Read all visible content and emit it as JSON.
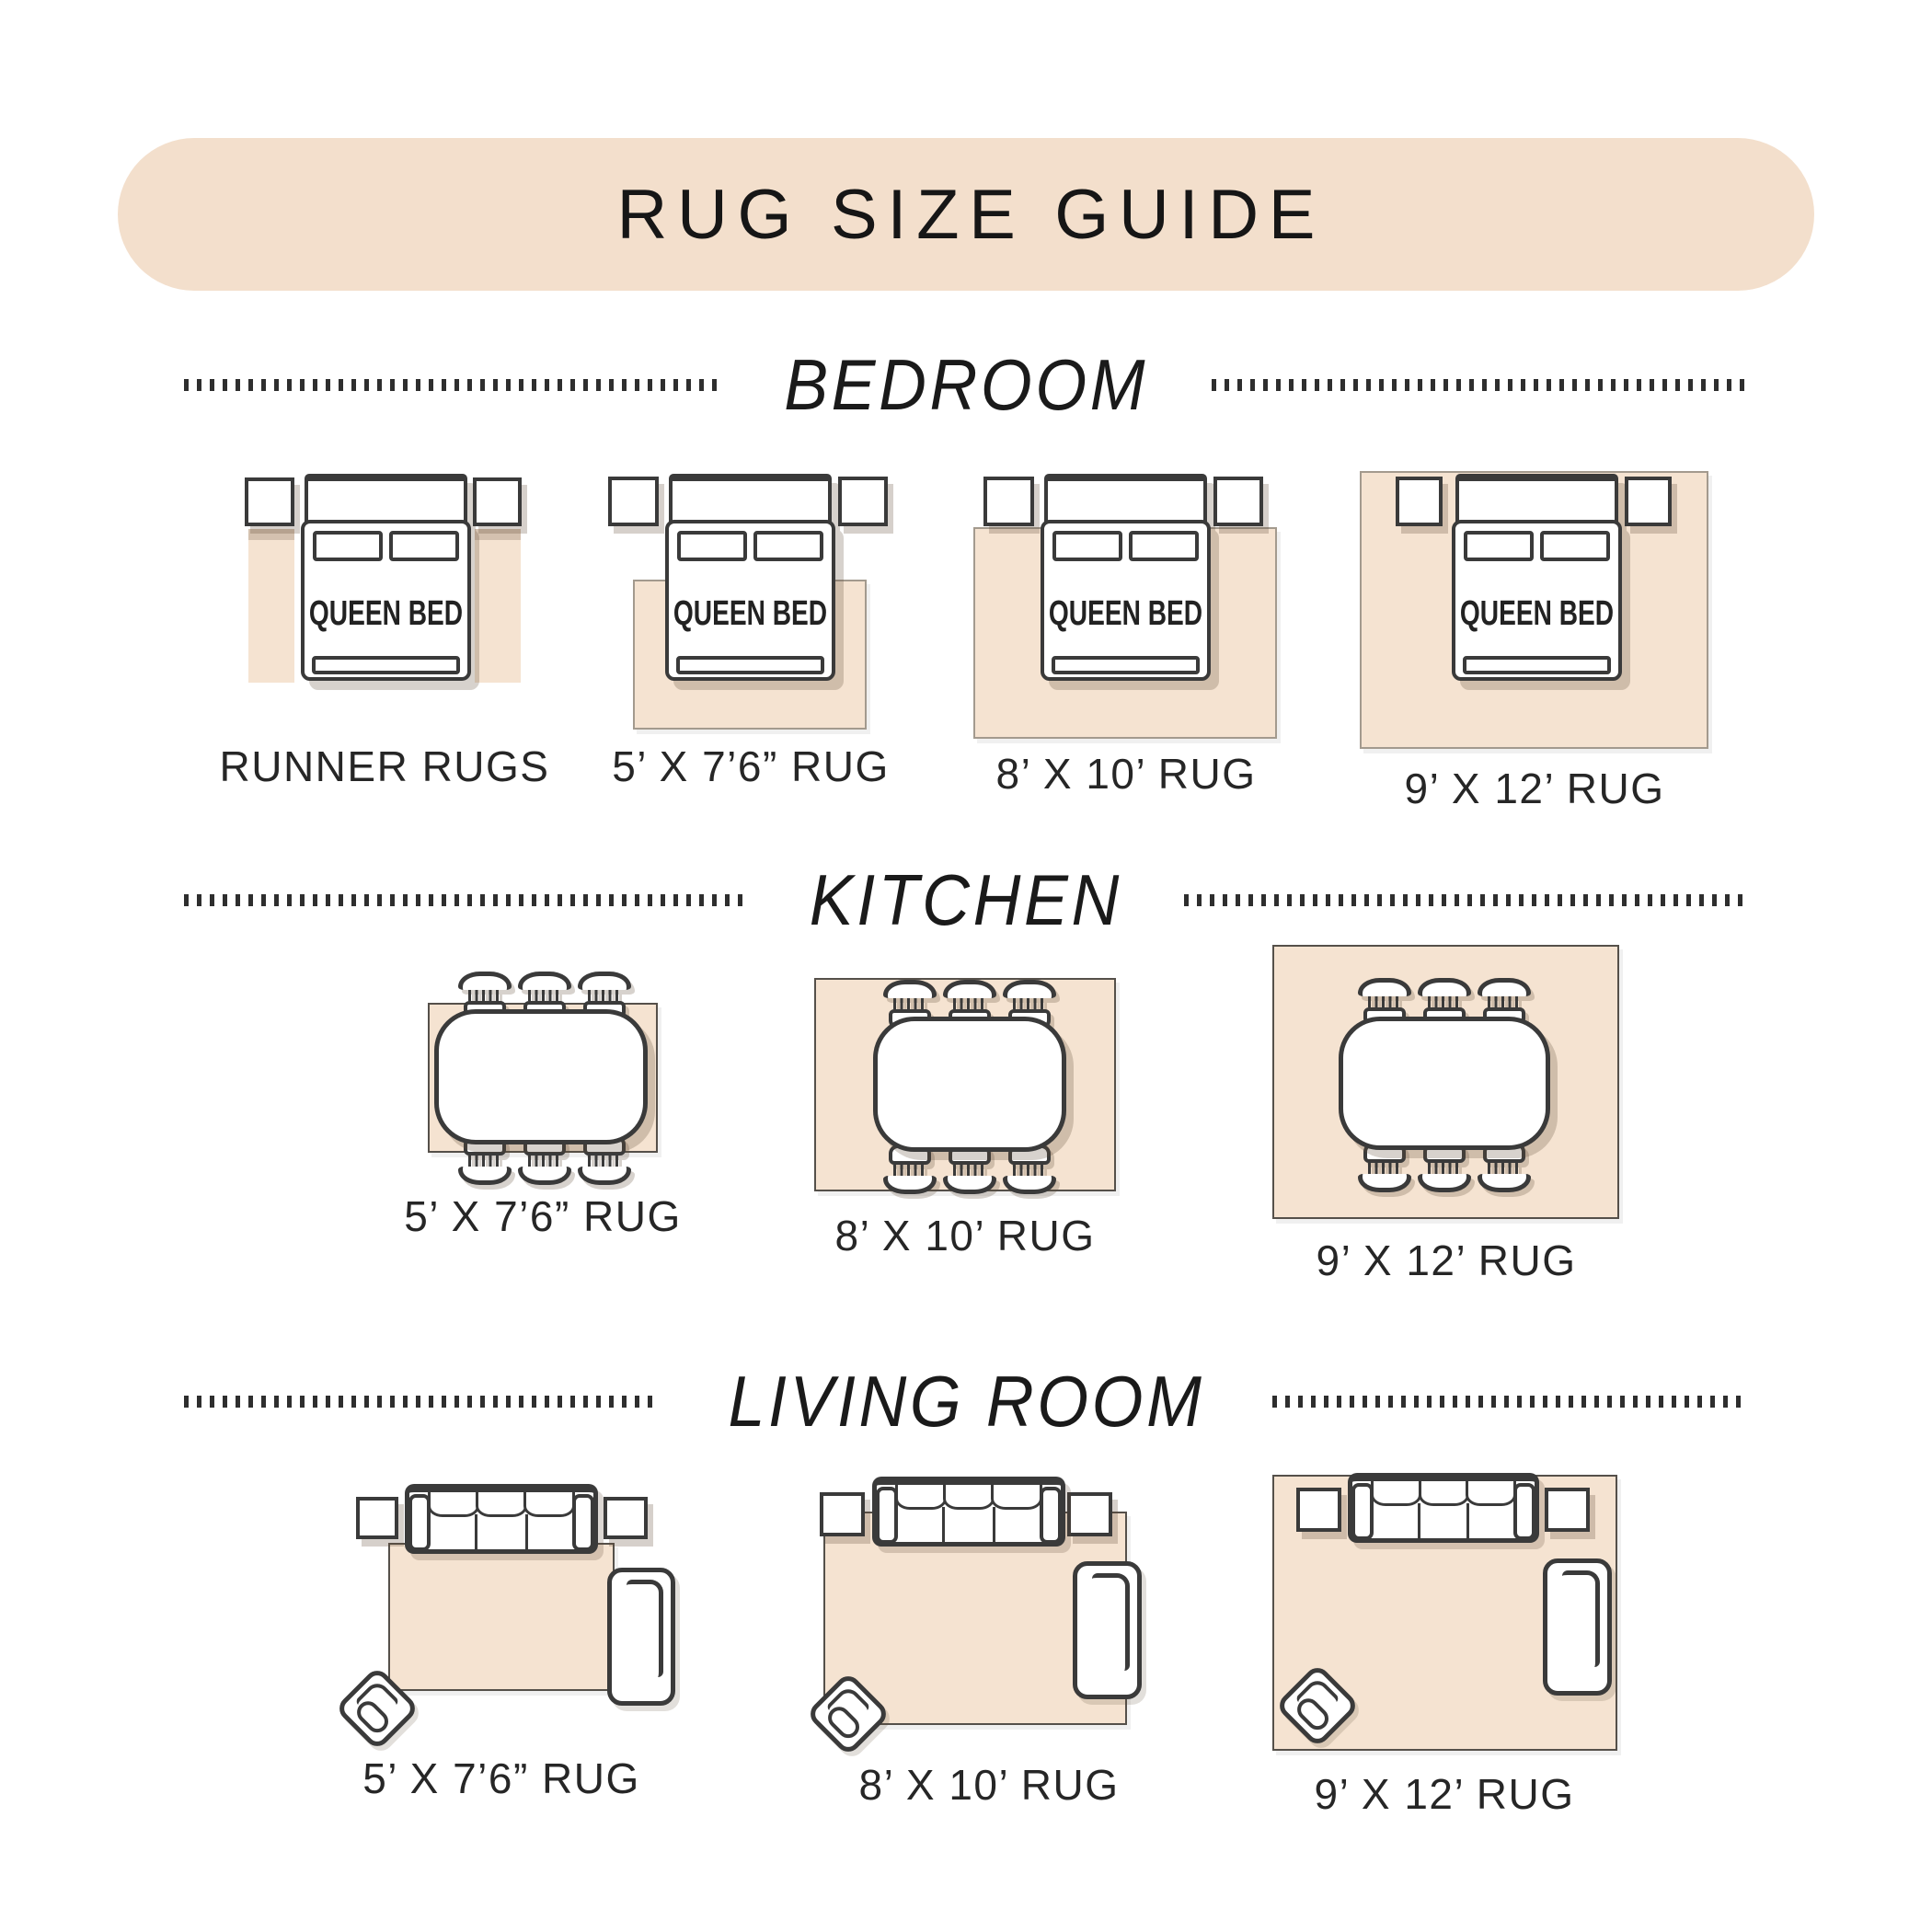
{
  "title": "RUG SIZE GUIDE",
  "bed_label": "QUEEN BED",
  "colors": {
    "banner_bg": "#f3dfcc",
    "rug_fill": "#f5e3d1",
    "outline": "#3a3a3a",
    "text": "#1c1c1c",
    "divider_dots": "#2e2e2e"
  },
  "sections": {
    "bedroom": {
      "label": "BEDROOM",
      "items": [
        "RUNNER RUGS",
        "5’ X 7’6” RUG",
        "8’ X 10’ RUG",
        "9’ X 12’ RUG"
      ]
    },
    "kitchen": {
      "label": "KITCHEN",
      "items": [
        "5’ X 7’6” RUG",
        "8’ X 10’ RUG",
        "9’ X 12’ RUG"
      ]
    },
    "living_room": {
      "label": "LIVING ROOM",
      "items": [
        "5’ X 7’6” RUG",
        "8’ X 10’ RUG",
        "9’ X 12’ RUG"
      ]
    }
  }
}
